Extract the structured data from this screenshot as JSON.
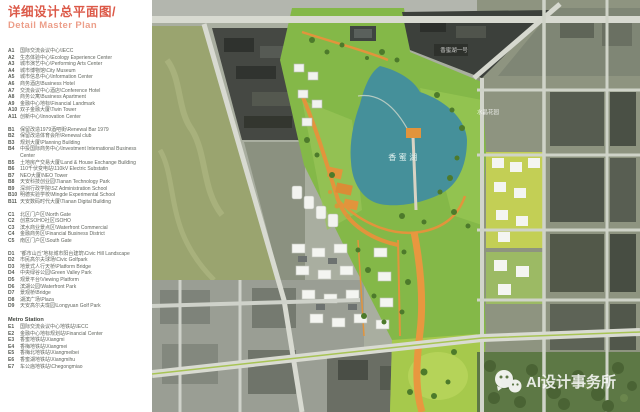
{
  "title": {
    "zh": "详细设计总平面图/",
    "en": "Detail Master Plan"
  },
  "legend": {
    "groups": [
      {
        "id": "A",
        "items": [
          {
            "code": "A1",
            "text": "国际交流会议中心\\IECC"
          },
          {
            "code": "A2",
            "text": "生态体验中心\\Ecology Experience Center"
          },
          {
            "code": "A3",
            "text": "城市演艺中心\\Performing Arts Center"
          },
          {
            "code": "A4",
            "text": "城市博物馆\\City Museum"
          },
          {
            "code": "A5",
            "text": "城市信息中心\\Information Center"
          },
          {
            "code": "A6",
            "text": "商务酒店\\Business Hotel"
          },
          {
            "code": "A7",
            "text": "交流会议中心酒店\\Conference Hotel"
          },
          {
            "code": "A8",
            "text": "商务公寓\\Business Apartment"
          },
          {
            "code": "A9",
            "text": "金融中心地标\\Financial Landmark"
          },
          {
            "code": "A10",
            "text": "双子金融大厦\\Twin Tower"
          },
          {
            "code": "A11",
            "text": "创新中心\\Innovation Center"
          }
        ]
      },
      {
        "id": "B",
        "items": [
          {
            "code": "B1",
            "text": "保留改造1979酒吧街\\Renewal Bar 1979"
          },
          {
            "code": "B2",
            "text": "保留改造体育会所\\Renewal club"
          },
          {
            "code": "B3",
            "text": "规划大厦\\Planning Building"
          },
          {
            "code": "B4",
            "text": "中投国际商务中心\\Investment International Business Center"
          },
          {
            "code": "B5",
            "text": "土地房产交易大厦\\Land & House Exchange Building"
          },
          {
            "code": "B6",
            "text": "110千伏变电站\\110kV Electric Substatin"
          },
          {
            "code": "B7",
            "text": "NEO大厦\\NEO Tower"
          },
          {
            "code": "B8",
            "text": "天安科技创业园\\Tianan Technology Park"
          },
          {
            "code": "B9",
            "text": "深圳行政学院\\SZ Administration School"
          },
          {
            "code": "B10",
            "text": "明德实验学校\\Mingde Experimental School"
          },
          {
            "code": "B11",
            "text": "天安数码时代大厦\\Tianan Digital Building"
          }
        ]
      },
      {
        "id": "C",
        "items": [
          {
            "code": "C1",
            "text": "北区门户区\\North Gate"
          },
          {
            "code": "C2",
            "text": "创意SOHO社区\\SOHO"
          },
          {
            "code": "C3",
            "text": "滨水商业景点区\\Waterfront Commercial"
          },
          {
            "code": "C4",
            "text": "金融商务区\\Financial Business District"
          },
          {
            "code": "C5",
            "text": "南区门户区\\South Gate"
          }
        ]
      },
      {
        "id": "D",
        "items": [
          {
            "code": "D1",
            "text": "“都市山丘”地标城市阳台建筑\\Civic Hill Landscape"
          },
          {
            "code": "D2",
            "text": "市民高尔夫球场\\Civic Golfpark"
          },
          {
            "code": "D3",
            "text": "地景式人行天桥\\Platform Bridge"
          },
          {
            "code": "D4",
            "text": "中央绿谷公园\\Green Valley Park"
          },
          {
            "code": "D5",
            "text": "观景平台\\Viewing Platform"
          },
          {
            "code": "D6",
            "text": "滨湖公园\\Waterfront Park"
          },
          {
            "code": "D7",
            "text": "景观桥\\Bridge"
          },
          {
            "code": "D8",
            "text": "湖滨广场\\Plaza"
          },
          {
            "code": "D9",
            "text": "天安高尔夫珑园\\Longyuan Golf Park"
          }
        ]
      },
      {
        "id": "E",
        "header": "Metro Station",
        "items": [
          {
            "code": "E1",
            "text": "国际交流会议中心地铁站\\IECC"
          },
          {
            "code": "E2",
            "text": "金融中心地标规划站\\Financial Center"
          },
          {
            "code": "E3",
            "text": "香蜜地铁站\\Xiangmi"
          },
          {
            "code": "E4",
            "text": "香梅地铁站\\Xiangmei"
          },
          {
            "code": "E5",
            "text": "香梅北地铁站\\Xiangmeibei"
          },
          {
            "code": "E6",
            "text": "香蜜湖地铁站\\Xiangmihu"
          },
          {
            "code": "E7",
            "text": "车公庙地铁站\\Chegongmiao"
          }
        ]
      }
    ]
  },
  "map": {
    "labels": {
      "lake": "香蜜湖",
      "top_right_estate": "香蜜湖一号",
      "crystal_garden": "水晶花园"
    },
    "watermark": "AI设计事务所",
    "colors": {
      "lake": "#45909a",
      "park_green": "#84b848",
      "golf_bright": "#a6c94c",
      "orange_path": "#e2943c",
      "road": "#d8dad1",
      "title_red": "#dc5948"
    }
  }
}
